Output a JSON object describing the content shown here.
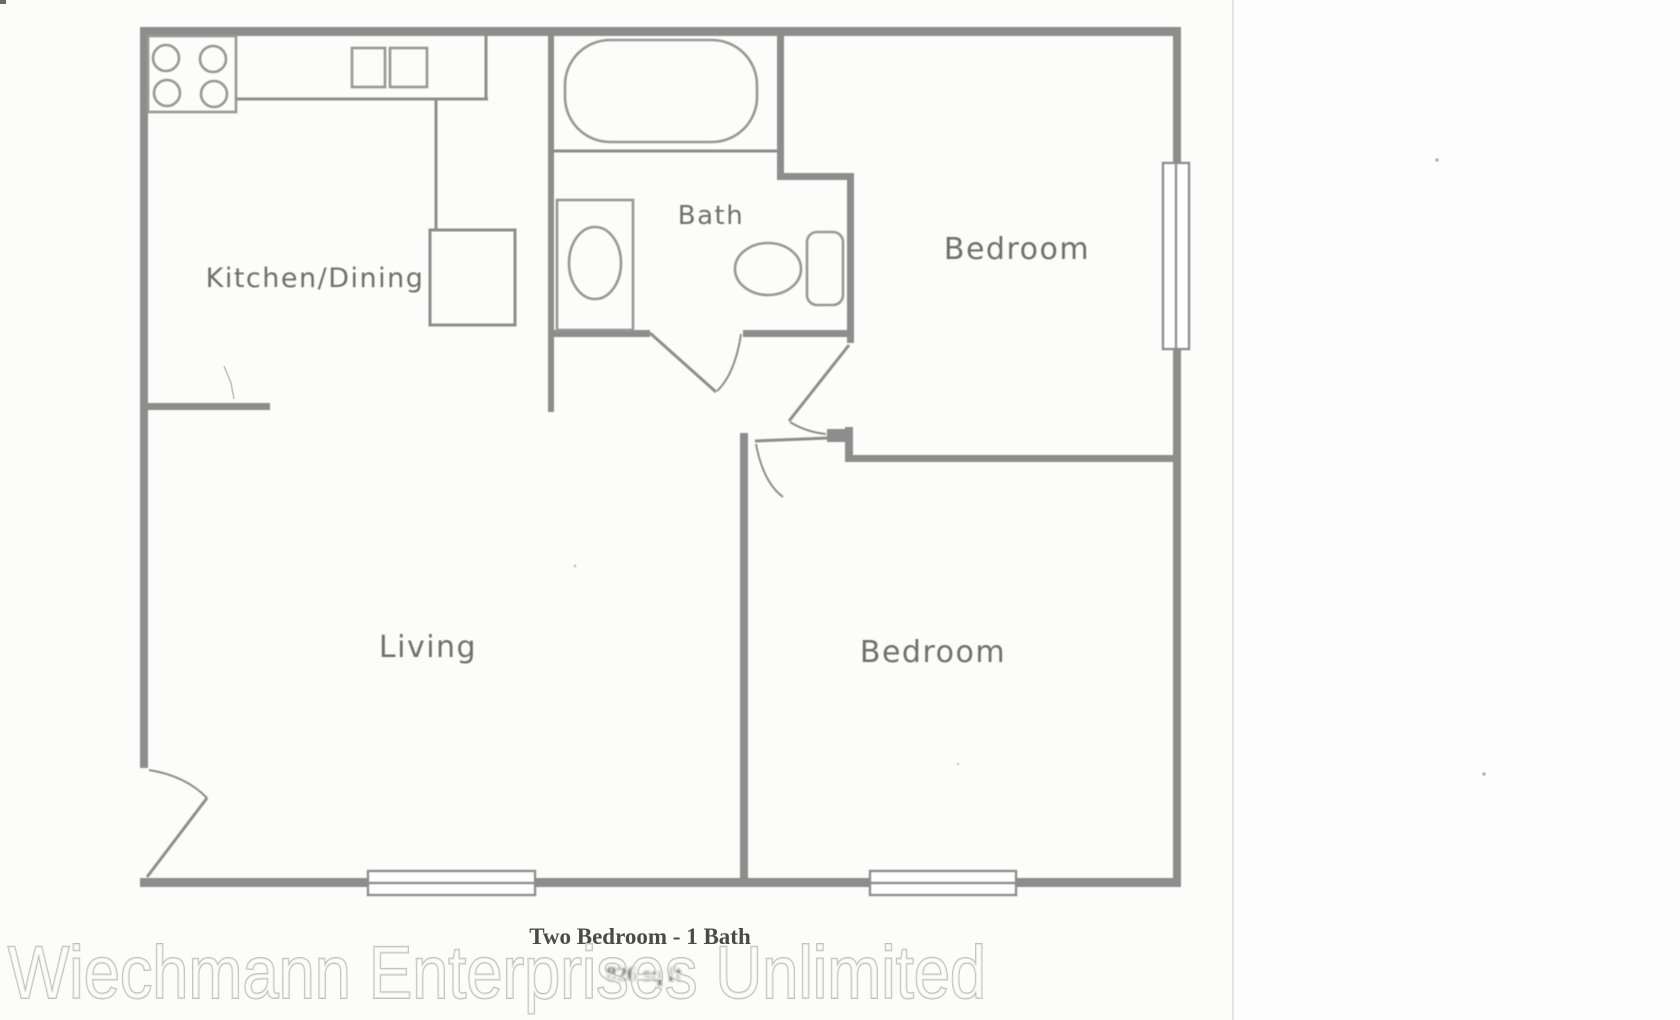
{
  "document": {
    "type": "apartment floor plan scan",
    "rooms": {
      "kitchen_dining": "Kitchen/Dining",
      "bath": "Bath",
      "bedroom_top": "Bedroom",
      "bedroom_bottom": "Bedroom",
      "living": "Living"
    },
    "caption": {
      "line1": "Two Bedroom - 1 Bath",
      "line2": "826 sq ft"
    },
    "fixtures": [
      "stove-icon",
      "kitchen-sink-icon",
      "bathtub-icon",
      "vanity-sink-icon",
      "toilet-icon",
      "window",
      "door-swing"
    ]
  },
  "watermark": {
    "text": "Wiechmann Enterprises Unlimited"
  },
  "colors": {
    "wall": "#8d8d8d",
    "fixture": "#979797",
    "label": "#6e6e6e",
    "caption": "#4a4a4a",
    "caption_faint": "#6f6f6f",
    "watermark_fill": "rgba(252,252,252,0.62)",
    "watermark_stroke": "#bfbfbd",
    "page_divider": "#e4e4e1",
    "right_panel": "#fdfdfe"
  }
}
